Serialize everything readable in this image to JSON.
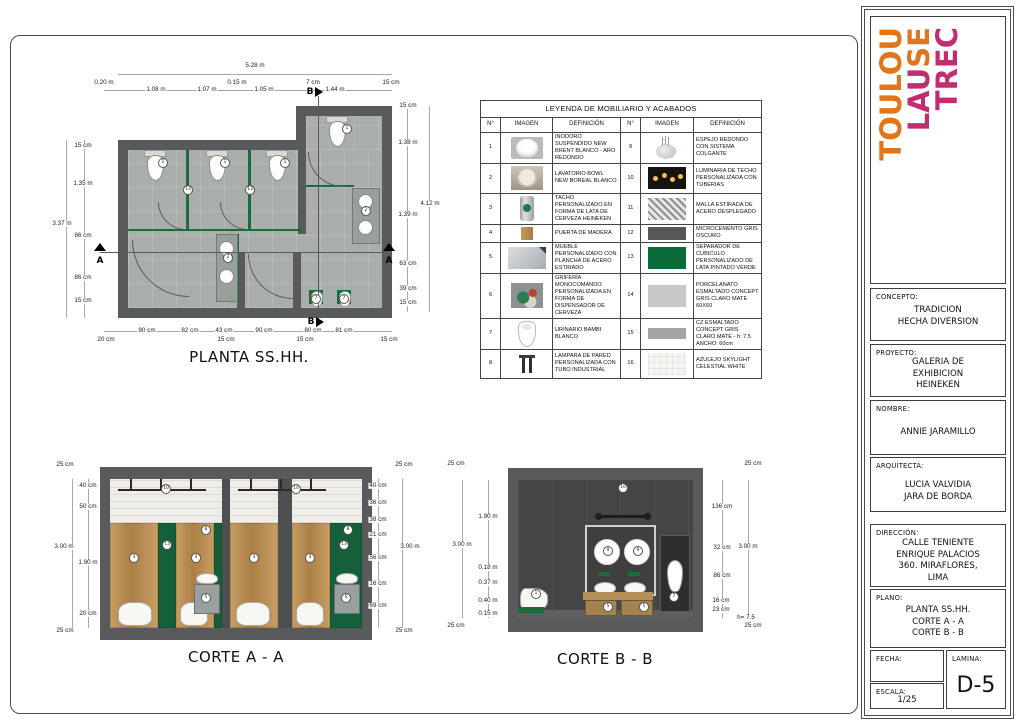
{
  "sheet": {
    "plan": {
      "title": "PLANTA SS.HH.",
      "dim_total_top": "5.28 m",
      "dims_top": [
        "0.20 m",
        "1.08 m",
        "1.07 m",
        "0.15 m",
        "1.05 m",
        "7 cm",
        "1.44 m",
        "15 cm"
      ],
      "dim_total_left": "3.37 m",
      "dims_left": [
        "15 cm",
        "1.35 m",
        "86 cm",
        "86 cm",
        "15 cm"
      ],
      "dim_total_right": "4.12 m",
      "dims_right": [
        "15 cm",
        "1.38 m",
        "1.39 m",
        "63 cm",
        "39 cm",
        "15 cm"
      ],
      "dims_bottom": [
        "90 cm",
        "82 cm",
        "43 cm",
        "90 cm",
        "80 cm",
        "81 cm"
      ],
      "dims_bottom2": [
        "20 cm",
        "15 cm",
        "15 cm",
        "15 cm"
      ],
      "marker_a": "A",
      "marker_b": "B"
    },
    "corte_a": {
      "title": "CORTE A - A",
      "dim_total_left": "3.00 m",
      "dims_left": [
        "25 cm",
        "40 cm",
        "50 cm",
        "1.90 m",
        "20 cm",
        "25 cm"
      ],
      "dim_total_right": "3.00 m",
      "dims_right": [
        "25 cm",
        "40 cm",
        "36 cm",
        "38 cm",
        "21 cm",
        "56 cm",
        "16 cm",
        "69 cm",
        "25 cm"
      ]
    },
    "corte_b": {
      "title": "CORTE B - B",
      "dim_total_left": "3.00 m",
      "dims_left": [
        "25 cm",
        "1.90 m",
        "0.18 m",
        "0.37 m",
        "0.40 m",
        "0.15 m",
        "25 cm"
      ],
      "dim_total_right": "3.00 m",
      "dims_right": [
        "25 cm",
        "136 cm",
        "32 cm",
        "86 cm",
        "16 cm",
        "23 cm",
        "h= 7.5",
        "25 cm"
      ]
    },
    "legend": {
      "title": "LEYENDA DE MOBILIARIO Y ACABADOS",
      "headers": [
        "N°",
        "IMAGEN",
        "DEFINICIÓN",
        "N°",
        "IMAGEN",
        "DEFINICIÓN"
      ],
      "rows": [
        {
          "n": "1",
          "def": "INODORO SUSPENDIDO NEW BRENT BLANCO - ARO REDONDO",
          "n2": "9",
          "def2": "ESPEJO REDONDO CON SISTEMA COLGANTE"
        },
        {
          "n": "2",
          "def": "LAVATORIO BOWL NEW BOREAL BLANCO",
          "n2": "10",
          "def2": "LUMINARIA DE TECHO PERSONALIZADA CON TUBERIAS"
        },
        {
          "n": "3",
          "def": "TACHO PERSONALIZADO EN FORMA DE LATA DE CERVEZA HEINEKEN",
          "n2": "11",
          "def2": "MALLA ESTIRADA DE ACERO DESPLEGADO"
        },
        {
          "n": "4",
          "def": "PUERTA DE MADERA",
          "n2": "12",
          "def2": "MICROCEMENTO GRIS OSCURO"
        },
        {
          "n": "5",
          "def": "MUEBLE PERSONALIZADO CON PLANCHA DE ACERO ESTRIADO",
          "n2": "13",
          "def2": "SEPARADOR DE CUBICULO PERSONALIZADO DE LATA PINTADO VERDE"
        },
        {
          "n": "6",
          "def": "GRIFERÍA MONOCOMANDO PERSONALIZADA EN FORMA DE DISPENSADOR DE CERVEZA",
          "n2": "14",
          "def2": "PORCELANATO ESMALTADO CONCEPT GRIS CLARO MATE 60X60"
        },
        {
          "n": "7",
          "def": "URINARIO BAMBI BLANCO",
          "n2": "15",
          "def2": "CZ ESMALTADO CONCEPT GRIS CLARO MATE - h: 7.5 ANCHO: 60cm"
        },
        {
          "n": "8",
          "def": "LAMPARA DE PARED PERSONALIZADA CON TUBO INDUSTRIAL",
          "n2": "16",
          "def2": "AZULEJO SKYLIGHT CELESTIAL WHITE"
        }
      ]
    },
    "titleblock": {
      "logo": {
        "word1": "TOULOU",
        "word2a": "LAU",
        "word2b": "SE",
        "word3": "TREC",
        "orange": "#E0761C",
        "magenta": "#C42C72"
      },
      "concepto_label": "CONCEPTO:",
      "concepto": "TRADICION\nHECHA DIVERSION",
      "proyecto_label": "PROYECTO:",
      "proyecto": "GALERIA DE\nEXHIBICION\nHEINEKEN",
      "nombre_label": "NOMBRE:",
      "nombre": "ANNIE JARAMILLO",
      "arquitecta_label": "ARQUITECTA:",
      "arquitecta": "LUCIA VALVIDIA\nJARA DE BORDA",
      "direccion_label": "DIRECCIÓN:",
      "direccion": "CALLE TENIENTE\nENRIQUE PALACIOS\n360. MIRAFLORES,\nLIMA",
      "plano_label": "PLANO:",
      "plano": "PLANTA SS.HH.\nCORTE A - A\nCORTE B - B",
      "fecha_label": "FECHA:",
      "fecha": "",
      "escala_label": "ESCALA:",
      "escala": "1/25",
      "lamina_label": "LAMINA:",
      "lamina": "D-5"
    },
    "callouts": {
      "toilet": "1",
      "sink": "2",
      "trash": "3",
      "door": "4",
      "cabinet": "5",
      "tap": "6",
      "urinal": "7",
      "lamp": "8",
      "mirror": "9",
      "ceiling_light": "10",
      "separator": "13"
    }
  }
}
